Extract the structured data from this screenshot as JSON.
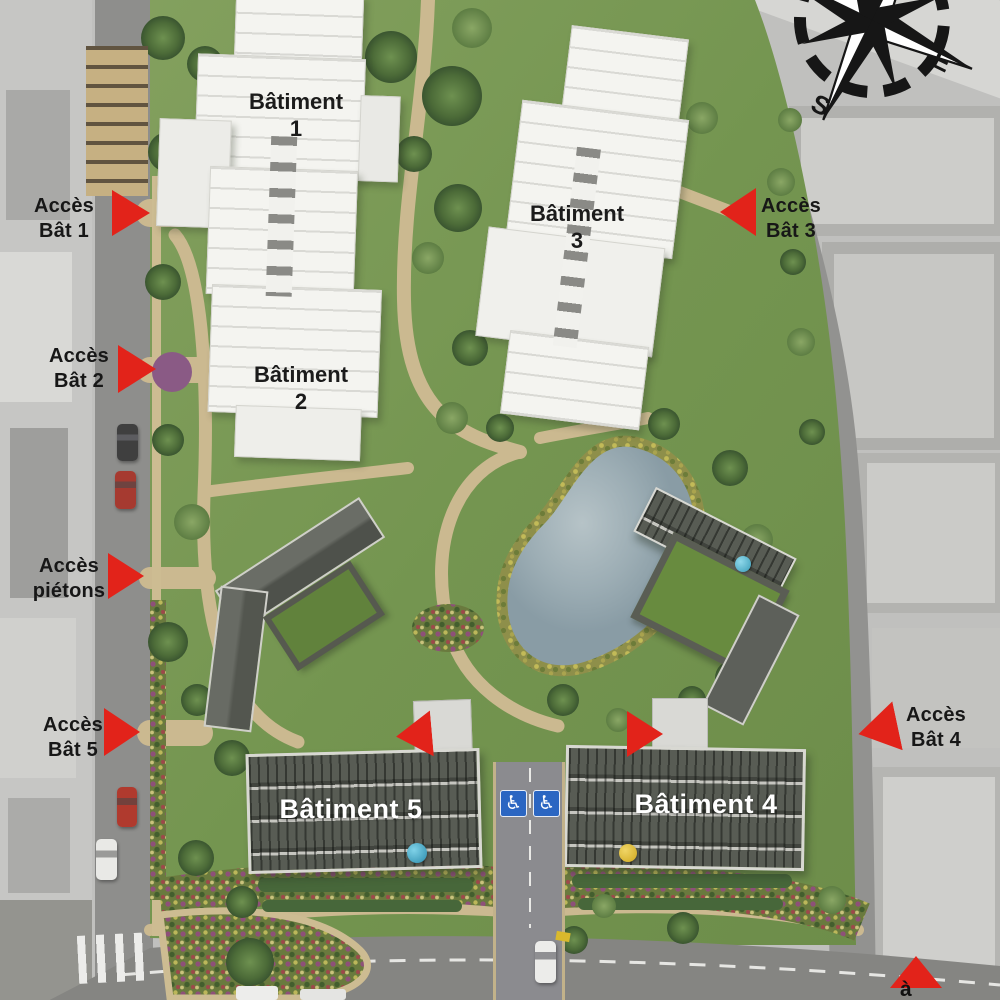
{
  "page": {
    "kind": "residential-masterplan-aerial-view"
  },
  "compass": {
    "east_label": "E",
    "south_label": "S"
  },
  "buildings": {
    "b1": {
      "label": "Bâtiment\n1"
    },
    "b2": {
      "label": "Bâtiment\n2"
    },
    "b3": {
      "label": "Bâtiment\n3"
    },
    "b4": {
      "label": "Bâtiment 4"
    },
    "b5": {
      "label": "Bâtiment 5"
    }
  },
  "access": {
    "bat1": {
      "label": "Accès\nBât 1"
    },
    "bat2": {
      "label": "Accès\nBât 2"
    },
    "pietons": {
      "label": "Accès\npiétons"
    },
    "bat5": {
      "label": "Accès\nBât 5"
    },
    "bat3": {
      "label": "Accès\nBât 3"
    },
    "bat4": {
      "label": "Accès\nBât 4"
    }
  },
  "partial_label": "à",
  "icons": {
    "handicap": "♿",
    "compass_rose": "compass-rose",
    "access_arrow": "red-triangle"
  },
  "colors": {
    "arrow_red": "#e2231a",
    "label_black": "#171717",
    "label_white": "#ffffff",
    "handicap_blue": "#2b66c2",
    "lawn_green": "#749550",
    "path_tan": "#cbb990",
    "pond_blue": "#9cadb4"
  }
}
